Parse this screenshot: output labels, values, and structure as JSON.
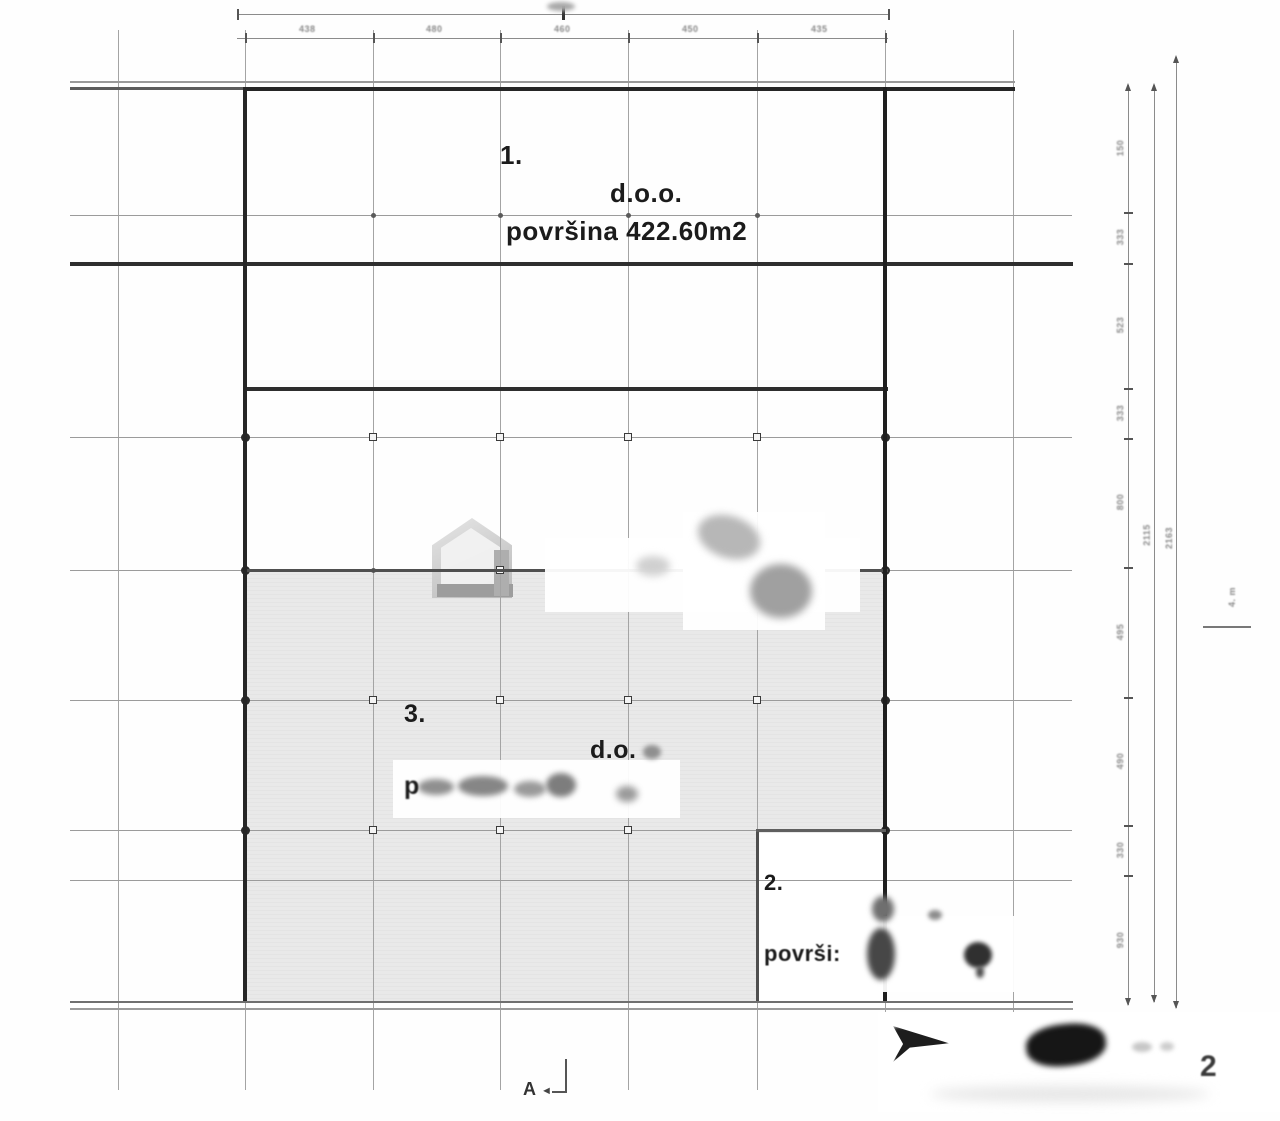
{
  "drawing": {
    "units": [
      {
        "number": "1.",
        "company": "d.o.o.",
        "area": "površina 422.60m2"
      },
      {
        "number": "2.",
        "area_partial": "površi:"
      },
      {
        "number": "3.",
        "company": "d.o.",
        "area_partial": "p"
      }
    ],
    "section_marker": {
      "letter": "A",
      "arrow": "◄"
    },
    "bottom_right_digit": "2",
    "level_mark": "4. m",
    "dimensions": {
      "top_segments": [
        "438",
        "480",
        "460",
        "450",
        "435"
      ],
      "right_inner_segments": [
        "150",
        "333",
        "523",
        "333",
        "800",
        "495",
        "490",
        "330",
        "930"
      ],
      "right_middle_total": "2115",
      "right_outer_total": "2163"
    },
    "colors": {
      "wall": "#262626",
      "grid": "#9b9b9b",
      "shade": "#e9e9e9",
      "dim_text": "#8a8a8a"
    }
  }
}
